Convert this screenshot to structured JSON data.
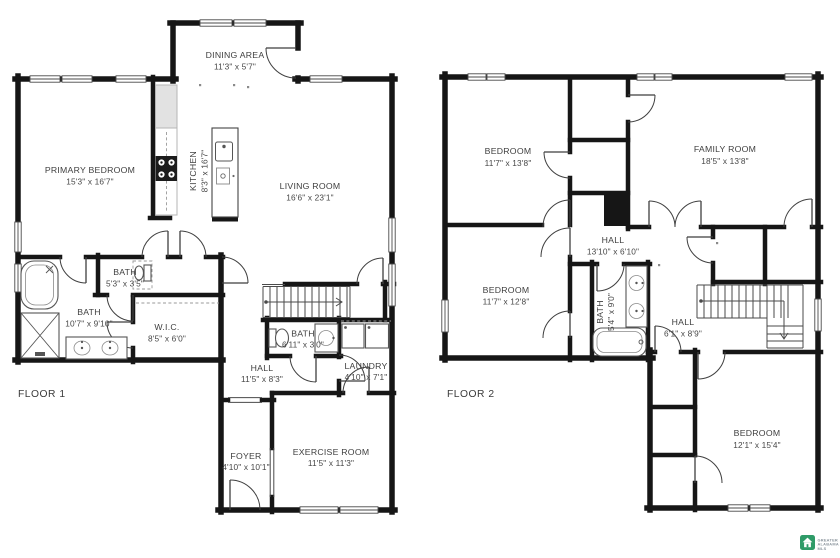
{
  "floor1": {
    "label": "FLOOR 1",
    "rooms": {
      "dining": {
        "name": "DINING AREA",
        "dims": "11'3\" x 5'7\""
      },
      "primary_bedroom": {
        "name": "PRIMARY BEDROOM",
        "dims": "15'3\" x 16'7\""
      },
      "kitchen": {
        "name": "KITCHEN",
        "dims": "8'3\" x 16'7\""
      },
      "living": {
        "name": "LIVING ROOM",
        "dims": "16'6\" x 23'1\""
      },
      "bath_small": {
        "name": "BATH",
        "dims": "5'3\" x 3'5\""
      },
      "bath_primary": {
        "name": "BATH",
        "dims": "10'7\" x 9'10\""
      },
      "wic": {
        "name": "W.I.C.",
        "dims": "8'5\" x 6'0\""
      },
      "bath_hall": {
        "name": "BATH",
        "dims": "6'11\" x 3'0\""
      },
      "hall": {
        "name": "HALL",
        "dims": "11'5\" x 8'3\""
      },
      "laundry": {
        "name": "LAUNDRY",
        "dims": "4'10\" x 7'1\""
      },
      "foyer": {
        "name": "FOYER",
        "dims": "4'10\" x 10'1\""
      },
      "exercise": {
        "name": "EXERCISE ROOM",
        "dims": "11'5\" x 11'3\""
      }
    }
  },
  "floor2": {
    "label": "FLOOR 2",
    "rooms": {
      "bedroom_nw": {
        "name": "BEDROOM",
        "dims": "11'7\" x 13'8\""
      },
      "family": {
        "name": "FAMILY ROOM",
        "dims": "18'5\" x 13'8\""
      },
      "hall_upper": {
        "name": "HALL",
        "dims": "13'10\" x 6'10\""
      },
      "bedroom_w": {
        "name": "BEDROOM",
        "dims": "11'7\" x 12'8\""
      },
      "bath": {
        "name": "BATH",
        "dims": "5'4\" x 9'0\""
      },
      "hall_lower": {
        "name": "HALL",
        "dims": "6'1\" x 8'9\""
      },
      "bedroom_se": {
        "name": "BEDROOM",
        "dims": "12'1\" x 15'4\""
      }
    }
  },
  "logo": {
    "icon": "house-icon",
    "line1": "GREATER",
    "line2": "ALABAMA",
    "line3": "MLS",
    "icon_color": "#2f9b68"
  },
  "colors": {
    "wall": "#161616",
    "label": "#3e3e3e",
    "background": "#ffffff"
  }
}
